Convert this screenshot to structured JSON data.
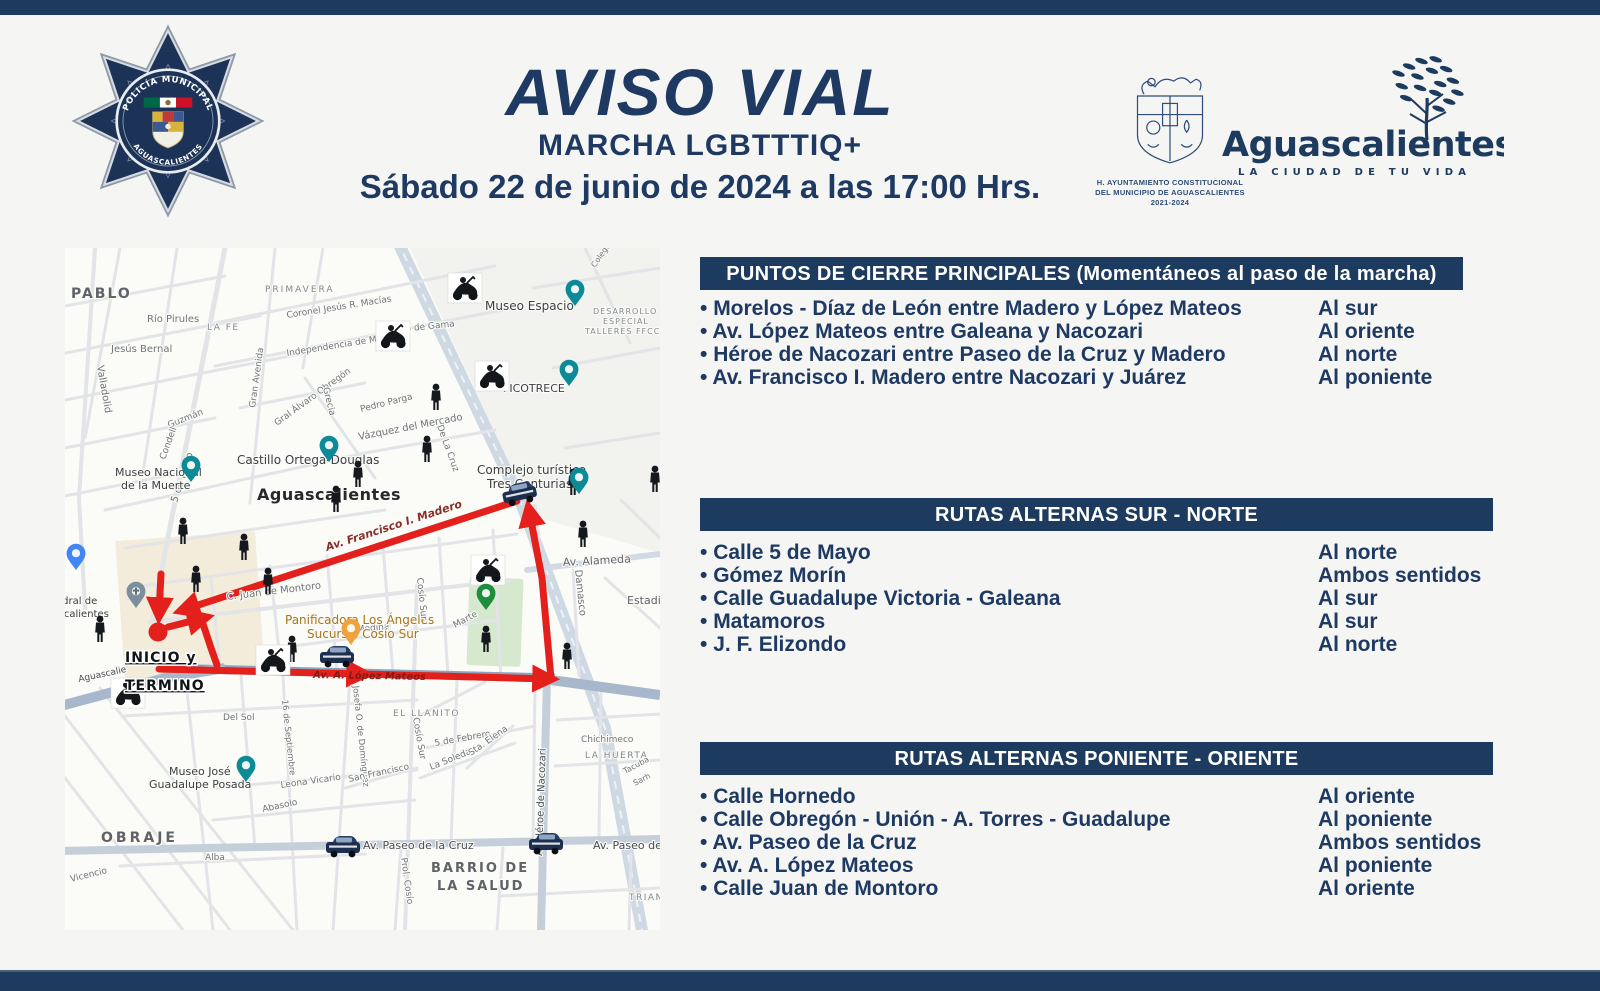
{
  "page": {
    "background": "#f5f5f3",
    "bar_color": "#1d3a5f",
    "accent_red": "#e3201b",
    "text_navy": "#1e3a63"
  },
  "header": {
    "title": "AVISO VIAL",
    "subtitle": "MARCHA LGBTTTIQ+",
    "datetime": "Sábado 22 de junio de 2024 a las 17:00 Hrs.",
    "badge": {
      "top": "POLICÍA MUNICIPAL",
      "bottom": "AGUASCALIENTES"
    },
    "crest_caption": [
      "H. AYUNTAMIENTO CONSTITUCIONAL",
      "DEL MUNICIPIO DE AGUASCALIENTES",
      "2021-2024"
    ],
    "city_logo": {
      "name": "Aguascalientes",
      "tagline": "LA CIUDAD DE TU VIDA"
    }
  },
  "sections": {
    "closures": {
      "title": "PUNTOS DE CIERRE PRINCIPALES (Momentáneos al paso de la marcha)",
      "items": [
        {
          "street": "Morelos - Díaz de León entre Madero y López Mateos",
          "direction": "Al sur"
        },
        {
          "street": "Av. López Mateos entre Galeana y Nacozari",
          "direction": "Al oriente"
        },
        {
          "street": "Héroe de Nacozari entre Paseo de la Cruz y Madero",
          "direction": "Al norte"
        },
        {
          "street": "Av. Francisco I. Madero entre Nacozari y Juárez",
          "direction": "Al poniente"
        }
      ]
    },
    "sur_norte": {
      "title": "RUTAS ALTERNAS SUR - NORTE",
      "items": [
        {
          "street": "Calle 5 de Mayo",
          "direction": "Al norte"
        },
        {
          "street": "Gómez Morín",
          "direction": "Ambos sentidos"
        },
        {
          "street": "Calle Guadalupe Victoria - Galeana",
          "direction": "Al sur"
        },
        {
          "street": "Matamoros",
          "direction": "Al sur"
        },
        {
          "street": "J. F. Elizondo",
          "direction": "Al norte"
        }
      ]
    },
    "pon_ote": {
      "title": "RUTAS ALTERNAS PONIENTE - ORIENTE",
      "items": [
        {
          "street": "Calle Hornedo",
          "direction": "Al oriente"
        },
        {
          "street": "Calle Obregón - Unión - A. Torres - Guadalupe",
          "direction": "Al poniente"
        },
        {
          "street": "Av. Paseo de la Cruz",
          "direction": "Ambos sentidos"
        },
        {
          "street": "Av. A. López Mateos",
          "direction": "Al poniente"
        },
        {
          "street": "Calle Juan de Montoro",
          "direction": "Al oriente"
        }
      ]
    }
  },
  "map": {
    "start": {
      "lines": [
        "INICIO y",
        "TERMINO"
      ],
      "x": 60,
      "y": 414
    },
    "route": {
      "color": "#e3201b",
      "dot": [
        93,
        384
      ],
      "segments": [
        {
          "pts": [
            [
              452,
              253
            ],
            [
              118,
              362
            ]
          ],
          "arrow": true
        },
        {
          "pts": [
            [
              96,
              326
            ],
            [
              94,
              366
            ]
          ],
          "arrow": true
        },
        {
          "pts": [
            [
              103,
              379
            ],
            [
              139,
              370
            ]
          ],
          "arrow": true
        },
        {
          "pts": [
            [
              137,
              373
            ],
            [
              146,
              400
            ],
            [
              152,
              417
            ]
          ],
          "arrow": false
        },
        {
          "pts": [
            [
              94,
              421
            ],
            [
              298,
              426
            ]
          ],
          "arrow": true
        },
        {
          "pts": [
            [
              296,
              426
            ],
            [
              484,
              431
            ]
          ],
          "arrow": true
        },
        {
          "pts": [
            [
              486,
              431
            ],
            [
              477,
              330
            ],
            [
              464,
              262
            ]
          ],
          "arrow": true
        }
      ],
      "street_labels": [
        {
          "t": "Av. Francisco I. Madero",
          "x": 262,
          "y": 303,
          "r": -18,
          "s": 11
        },
        {
          "t": "Av. A. López Mateos",
          "x": 248,
          "y": 430,
          "r": 1,
          "s": 10
        }
      ]
    },
    "labels": [
      {
        "t": "PABLO",
        "x": 6,
        "y": 50,
        "s": 14,
        "c": "#5f6368",
        "w": 1,
        "ls": 2
      },
      {
        "t": "Río Pirules",
        "x": 82,
        "y": 74,
        "s": 10
      },
      {
        "t": "PRIMAVERA",
        "x": 200,
        "y": 44,
        "s": 9,
        "ls": 2,
        "c": "#84898e"
      },
      {
        "t": "LA FE",
        "x": 142,
        "y": 82,
        "s": 9,
        "ls": 1.5,
        "c": "#84898e"
      },
      {
        "t": "Coronel Jesús R. Macías",
        "x": 222,
        "y": 70,
        "s": 9,
        "r": -9
      },
      {
        "t": "Independencia de México",
        "x": 222,
        "y": 108,
        "s": 9,
        "r": -9
      },
      {
        "t": "Jesús Bernal",
        "x": 46,
        "y": 104,
        "s": 10
      },
      {
        "t": "Valladolid",
        "x": 32,
        "y": 118,
        "s": 10,
        "r": 80
      },
      {
        "t": "5 de Mayo",
        "x": 112,
        "y": 255,
        "s": 10,
        "r": -72
      },
      {
        "t": "Gran Avenida",
        "x": 190,
        "y": 160,
        "s": 9,
        "r": -82
      },
      {
        "t": "Guzmán",
        "x": 104,
        "y": 180,
        "s": 9,
        "r": -22
      },
      {
        "t": "Condell",
        "x": 100,
        "y": 212,
        "s": 9,
        "r": -70
      },
      {
        "t": "Gral Álvaro Obregón",
        "x": 212,
        "y": 178,
        "s": 9,
        "r": -36
      },
      {
        "t": "Grecia",
        "x": 258,
        "y": 140,
        "s": 9,
        "r": 76
      },
      {
        "t": "Castillo Ortega-Douglas",
        "x": 172,
        "y": 216,
        "s": 12,
        "c": "#3c4043"
      },
      {
        "t": "Aguascalientes",
        "x": 192,
        "y": 252,
        "s": 16,
        "c": "#26282c",
        "w": 1,
        "ls": 0.5
      },
      {
        "t": "Museo Nacional",
        "x": 50,
        "y": 228,
        "s": 11,
        "c": "#3c4043"
      },
      {
        "t": "de la Muerte",
        "x": 56,
        "y": 241,
        "s": 11,
        "c": "#3c4043"
      },
      {
        "t": "Museo Espacio",
        "x": 420,
        "y": 62,
        "s": 12,
        "c": "#3c4043"
      },
      {
        "t": "DESARROLLO",
        "x": 528,
        "y": 66,
        "s": 8,
        "ls": 1,
        "c": "#84898e"
      },
      {
        "t": "ESPECIAL",
        "x": 538,
        "y": 76,
        "s": 8,
        "ls": 1,
        "c": "#84898e"
      },
      {
        "t": "TALLERES FFCC",
        "x": 520,
        "y": 86,
        "s": 8,
        "ls": 1,
        "c": "#84898e"
      },
      {
        "t": "FICOTRECE",
        "x": 438,
        "y": 144,
        "s": 11,
        "c": "#3c4043"
      },
      {
        "t": "Vázquez del Mercado",
        "x": 294,
        "y": 192,
        "s": 10,
        "r": -11
      },
      {
        "t": "Pedro Parga",
        "x": 296,
        "y": 164,
        "s": 9,
        "r": -14
      },
      {
        "t": "co de Gama",
        "x": 336,
        "y": 84,
        "s": 9,
        "r": -6
      },
      {
        "t": "De La Cruz",
        "x": 372,
        "y": 178,
        "s": 9,
        "r": 70
      },
      {
        "t": "Complejo turístico",
        "x": 412,
        "y": 226,
        "s": 12,
        "c": "#3c4043"
      },
      {
        "t": "Tres Centurias",
        "x": 422,
        "y": 240,
        "s": 12,
        "c": "#3c4043"
      },
      {
        "t": "Av. Alameda",
        "x": 498,
        "y": 318,
        "s": 11,
        "c": "#5f6368",
        "r": -3
      },
      {
        "t": "Damasco",
        "x": 510,
        "y": 322,
        "s": 10,
        "r": 84
      },
      {
        "t": "Estadio",
        "x": 562,
        "y": 356,
        "s": 11,
        "c": "#5f6368"
      },
      {
        "t": "Colegio",
        "x": 530,
        "y": 20,
        "s": 8,
        "r": -55
      },
      {
        "t": "C. Juan de Montoro",
        "x": 162,
        "y": 352,
        "s": 10,
        "r": -7
      },
      {
        "t": "Medina",
        "x": 292,
        "y": 384,
        "s": 9,
        "r": -5
      },
      {
        "t": "Panificadora Los Ángeles",
        "x": 220,
        "y": 376,
        "s": 12,
        "c": "#a8741a"
      },
      {
        "t": "Sucursal Cosío Sur",
        "x": 242,
        "y": 390,
        "s": 12,
        "c": "#a8741a"
      },
      {
        "t": "Cosío Sur",
        "x": 352,
        "y": 330,
        "s": 9,
        "r": 84
      },
      {
        "t": "Cosío Sur",
        "x": 348,
        "y": 470,
        "s": 9,
        "r": 80
      },
      {
        "t": "Marte",
        "x": 390,
        "y": 380,
        "s": 9,
        "r": -28
      },
      {
        "t": "Catedral de",
        "x": -26,
        "y": 356,
        "s": 10,
        "c": "#3c4043"
      },
      {
        "t": "Aguascalientes",
        "x": -32,
        "y": 369,
        "s": 10,
        "c": "#3c4043"
      },
      {
        "t": "Del Sol",
        "x": 158,
        "y": 472,
        "s": 9
      },
      {
        "t": "16 de Septiembre",
        "x": 217,
        "y": 452,
        "s": 8.5,
        "r": 84
      },
      {
        "t": "Josefa O. de Domínguez",
        "x": 288,
        "y": 438,
        "s": 8.5,
        "r": 84
      },
      {
        "t": "Museo José",
        "x": 104,
        "y": 527,
        "s": 11,
        "c": "#3c4043"
      },
      {
        "t": "Guadalupe Posada",
        "x": 84,
        "y": 540,
        "s": 11,
        "c": "#3c4043"
      },
      {
        "t": "Leona Vicario",
        "x": 216,
        "y": 540,
        "s": 9,
        "r": -8
      },
      {
        "t": "Abasolo",
        "x": 198,
        "y": 564,
        "s": 9,
        "r": -12
      },
      {
        "t": "OBRAJE",
        "x": 36,
        "y": 594,
        "s": 14,
        "c": "#5f6368",
        "w": 1,
        "ls": 3
      },
      {
        "t": "Alba",
        "x": 140,
        "y": 612,
        "s": 9
      },
      {
        "t": "Vicencio",
        "x": 6,
        "y": 634,
        "s": 9,
        "r": -14
      },
      {
        "t": "EL LLANITO",
        "x": 328,
        "y": 468,
        "s": 9,
        "ls": 1.5,
        "c": "#84898e"
      },
      {
        "t": "5 de Febrero",
        "x": 370,
        "y": 498,
        "s": 9,
        "r": -10
      },
      {
        "t": "La Soledad",
        "x": 366,
        "y": 522,
        "s": 9,
        "r": -22
      },
      {
        "t": "Sta. Elena",
        "x": 406,
        "y": 508,
        "s": 9,
        "r": -35
      },
      {
        "t": "San Francisco",
        "x": 284,
        "y": 534,
        "s": 9,
        "r": -12
      },
      {
        "t": "Prol. Cosío",
        "x": 336,
        "y": 610,
        "s": 9,
        "r": 82
      },
      {
        "t": "Av. Paseo de la Cruz",
        "x": 298,
        "y": 601,
        "s": 11,
        "c": "#454c52"
      },
      {
        "t": "Av. Paseo de la C",
        "x": 528,
        "y": 601,
        "s": 11,
        "c": "#454c52"
      },
      {
        "t": "BARRIO DE",
        "x": 366,
        "y": 624,
        "s": 13,
        "c": "#5f6368",
        "w": 1,
        "ls": 2
      },
      {
        "t": "LA SALUD",
        "x": 372,
        "y": 642,
        "s": 13,
        "c": "#5f6368",
        "w": 1,
        "ls": 2
      },
      {
        "t": "Chichimeco",
        "x": 516,
        "y": 494,
        "s": 9
      },
      {
        "t": "LA HUERTA",
        "x": 520,
        "y": 510,
        "s": 9,
        "ls": 1.5,
        "c": "#84898e"
      },
      {
        "t": "Tacuba",
        "x": 560,
        "y": 526,
        "s": 8,
        "r": -28
      },
      {
        "t": "Sarh",
        "x": 570,
        "y": 538,
        "s": 8,
        "r": -28
      },
      {
        "t": "TRIANA",
        "x": 564,
        "y": 652,
        "s": 9,
        "ls": 1.5,
        "c": "#84898e"
      },
      {
        "t": "Aguascalie",
        "x": 14,
        "y": 434,
        "s": 9,
        "r": -12,
        "c": "#454c52"
      },
      {
        "t": "Av Héroe de Nacozari",
        "x": 477,
        "y": 608,
        "s": 10,
        "r": -88,
        "c": "#454c52"
      }
    ],
    "pois": [
      {
        "x": 510,
        "y": 58,
        "c": "#0d8a98"
      },
      {
        "x": 504,
        "y": 138,
        "c": "#0d8a98"
      },
      {
        "x": 514,
        "y": 246,
        "c": "#0d8a98"
      },
      {
        "x": 264,
        "y": 214,
        "c": "#0d8a98"
      },
      {
        "x": 126,
        "y": 234,
        "c": "#0d8a98"
      },
      {
        "x": 181,
        "y": 534,
        "c": "#0d8a98"
      },
      {
        "x": 286,
        "y": 397,
        "c": "#f0a33c"
      },
      {
        "x": 421,
        "y": 362,
        "c": "#1e8e3e"
      },
      {
        "x": 11,
        "y": 322,
        "c": "#4285f4"
      },
      {
        "x": 71,
        "y": 360,
        "c": "#7d8e9c",
        "g": "cross"
      }
    ],
    "persons": [
      [
        371,
        160
      ],
      [
        362,
        212
      ],
      [
        293,
        237
      ],
      [
        271,
        262
      ],
      [
        118,
        294
      ],
      [
        179,
        310
      ],
      [
        131,
        342
      ],
      [
        203,
        344
      ],
      [
        35,
        392
      ],
      [
        227,
        412
      ],
      [
        421,
        402
      ],
      [
        502,
        419
      ],
      [
        508,
        245
      ],
      [
        518,
        297
      ],
      [
        590,
        242
      ]
    ],
    "motos": [
      [
        400,
        40
      ],
      [
        328,
        88
      ],
      [
        427,
        128
      ],
      [
        423,
        322
      ],
      [
        208,
        412
      ],
      [
        63,
        445
      ]
    ],
    "cars": [
      [
        455,
        248,
        -12
      ],
      [
        272,
        411,
        0
      ],
      [
        278,
        601,
        0
      ],
      [
        481,
        598,
        0
      ]
    ]
  }
}
